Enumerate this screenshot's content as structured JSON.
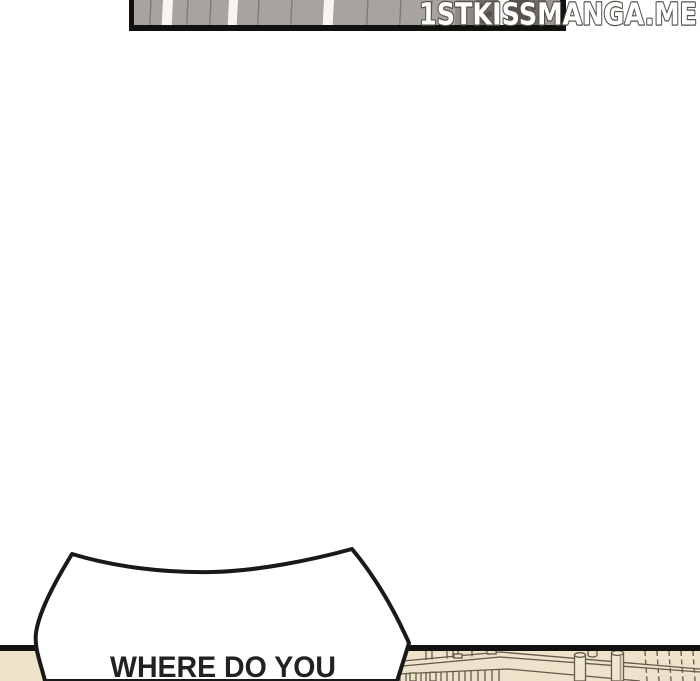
{
  "page": {
    "background_color": "#ffffff",
    "panel_border_color": "#121110"
  },
  "watermark": {
    "text": "1STKISSMANGA.ME",
    "fill_color": "#ffffff",
    "outline_color": "#565049"
  },
  "top_panel": {
    "description": "partial panel of gray fence planks with white gaps and dark shaded right section",
    "plank_color": "#a7a39e",
    "gap_color": "#f6f5f2",
    "plank_line_color": "#7e7a74",
    "dark_region_colors": [
      "#8e8a84",
      "#6f6b63",
      "#57534c",
      "#999590"
    ]
  },
  "speech_bubble": {
    "text": "WHERE DO YOU",
    "fill_color": "#ffffff",
    "outline_color": "#191919",
    "text_color": "#222222"
  },
  "bottom_panel": {
    "description": "partial panel of a wooden railing / stair corner in beige line art",
    "background_color": "#ece3ca",
    "line_color": "#645a4c",
    "border_color": "#121110"
  }
}
